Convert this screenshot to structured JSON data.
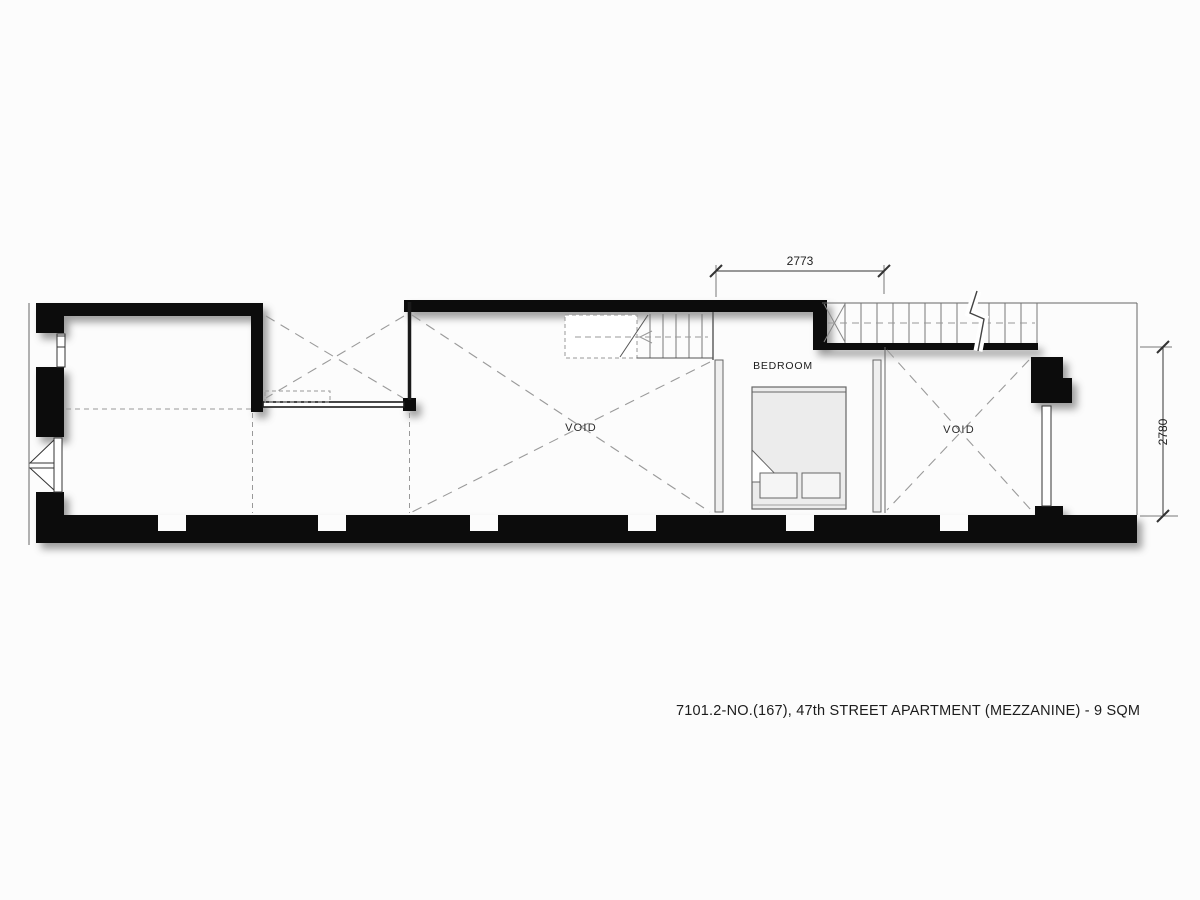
{
  "drawing": {
    "title": "7101.2-NO.(167), 47th STREET APARTMENT (MEZZANINE) - 9 SQM",
    "rooms": {
      "bedroom_label": "BEDROOM"
    },
    "voids": {
      "left_label": "VOID",
      "right_label": "VOID"
    },
    "dimensions": {
      "width_top": "2773",
      "height_right": "2780"
    },
    "colors": {
      "wall": "#0c0c0c",
      "thin_line": "#555555",
      "dashed_line": "#999999",
      "bed_fill": "#ececec",
      "background": "#fcfcfc",
      "text": "#1d1d1d"
    }
  }
}
